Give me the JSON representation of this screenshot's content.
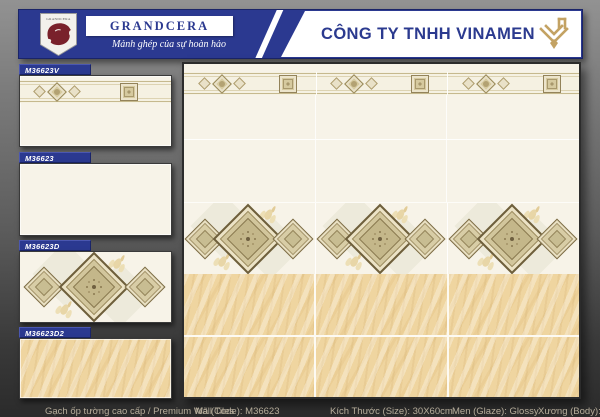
{
  "header": {
    "company": "CÔNG TY TNHH VINAMEN",
    "brand": "GRANDCERA",
    "brand_shield": "GRANDCERA",
    "tagline": "Mảnh ghép của sự hoàn hảo"
  },
  "colors": {
    "navy": "#2b3990",
    "gold": "#c3a263",
    "maroon": "#79212b",
    "cream": "#f7f3e8",
    "beige": "#efd5a0"
  },
  "sidebar": {
    "items": [
      {
        "code": "M36623V"
      },
      {
        "code": "M36623"
      },
      {
        "code": "M36623D"
      },
      {
        "code": "M36623D2"
      }
    ]
  },
  "footer": {
    "items": [
      {
        "label": "Gạch ốp tường cao cấp / Premium Wall Tiles"
      },
      {
        "label": "Mã (Code): M36623"
      },
      {
        "label": "Kích Thước (Size): 30X60cm"
      },
      {
        "label": "Men (Glaze): Glossy"
      },
      {
        "label": "Xương (Body): Ceramic"
      }
    ]
  }
}
